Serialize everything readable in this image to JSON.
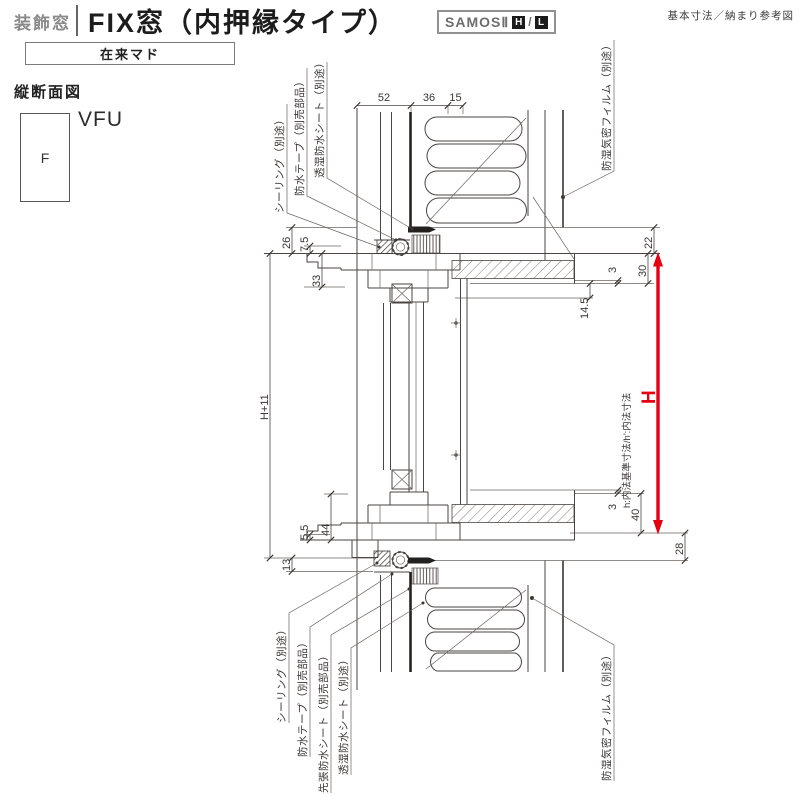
{
  "header": {
    "category": "装飾窓",
    "title": "FIX窓（内押縁タイプ）",
    "series": "SAMOSⅡ",
    "series_h": "H",
    "series_sep": "/",
    "series_l": "L",
    "ref_note": "基本寸法／納まり参考図",
    "frame_type": "在来マド"
  },
  "section": {
    "view_title": "縦断面図",
    "symbol": "F",
    "window_code": "VFU"
  },
  "dims": {
    "top": [
      "52",
      "36",
      "15"
    ],
    "left": {
      "soffit": "26",
      "d75": "7.5",
      "d33": "33",
      "height_plus": "H+11",
      "d55": "5.5",
      "d44": "44",
      "d13": "13"
    },
    "right": {
      "d22": "22",
      "d30": "30",
      "d3_top": "3",
      "d145": "14.5",
      "d3_bottom": "3",
      "d40": "40",
      "d28": "28"
    },
    "h_arrow": "H",
    "h_note": "h:内法基準寸法/h':内法寸法"
  },
  "labels": {
    "top_left": [
      "シーリング（別途）",
      "防水テープ（別売部品）",
      "透湿防水シート（別途）"
    ],
    "top_right": "防湿気密フィルム（別途）",
    "bottom_left": [
      "シーリング（別途）",
      "防水テープ（別売部品）",
      "先張防水シート（別売部品）",
      "透湿防水シート（別途）"
    ],
    "bottom_right": "防湿気密フィルム（別途）"
  },
  "colors": {
    "accent_red": "#e60012",
    "line": "#4a4543"
  }
}
